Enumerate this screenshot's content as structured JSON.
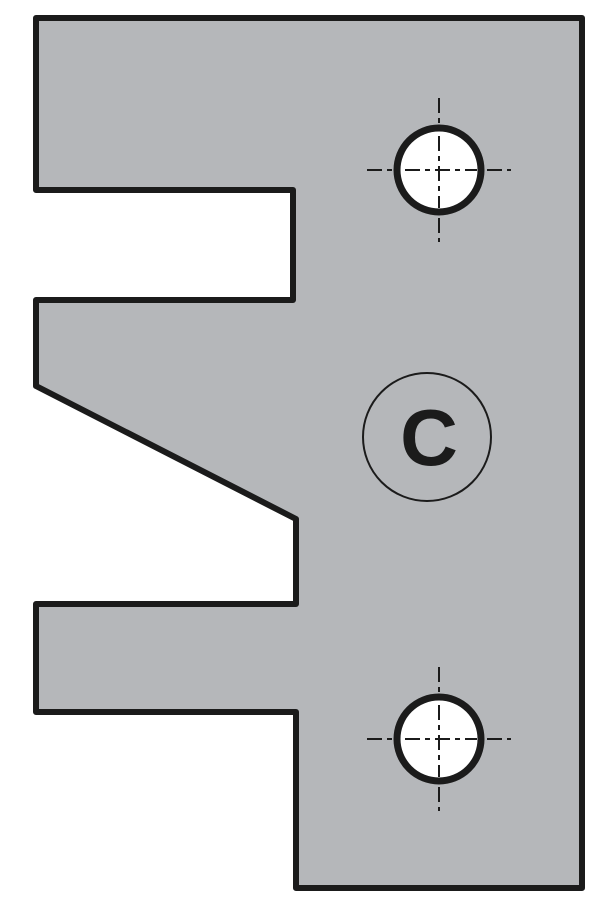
{
  "diagram": {
    "type": "technical-profile-drawing",
    "description": "Profile knife / cutter plate cross-section with two mounting holes and profile letter label",
    "colors": {
      "part_fill": "#b5b7ba",
      "line": "#1b1b1b",
      "hole_fill": "#ffffff",
      "background": "#ffffff"
    },
    "outline_points": "36,18 582,18 582,888 296,888 296,712 36,712 36,604 296,604 296,519 36,386 36,300 293,300 293,190 36,190",
    "outline_stroke_width": 6,
    "holes": [
      {
        "name": "top",
        "cx": 439,
        "cy": 170,
        "r": 42,
        "stroke_width": 7,
        "crosshair_extent": 72,
        "crosshair_stroke_width": 2,
        "crosshair_dash": "15 5 5 5"
      },
      {
        "name": "bottom",
        "cx": 439,
        "cy": 739,
        "r": 42,
        "stroke_width": 7,
        "crosshair_extent": 72,
        "crosshair_stroke_width": 2,
        "crosshair_dash": "15 5 5 5"
      }
    ],
    "label_circle": {
      "cx": 427,
      "cy": 437,
      "r": 64,
      "stroke_width": 2
    },
    "label": {
      "text": "C",
      "font_size": 80,
      "text_x": 429,
      "text_baseline_y": 465
    }
  }
}
